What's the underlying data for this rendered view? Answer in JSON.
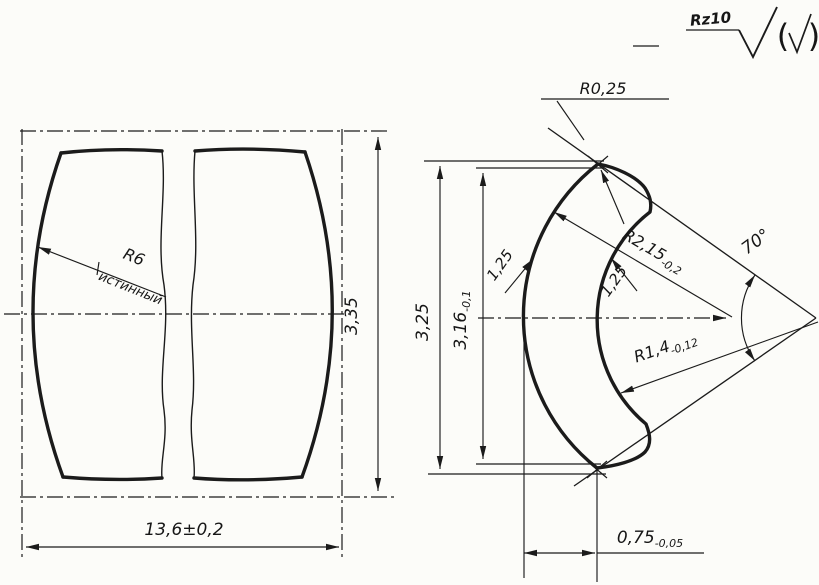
{
  "drawing": {
    "surface_finish": {
      "roughness_grade": "Rz10",
      "paren_open": "(",
      "paren_close": ")"
    },
    "left_view": {
      "radius_label": "R6",
      "radius_note": "истинный",
      "height_dim": "3,35",
      "width_dim": "13,6±0,2"
    },
    "right_view": {
      "tip_radius": "R0,25",
      "outer_height": "3,25",
      "inner_height": "3,16",
      "inner_height_tol": "-0,1",
      "outer_thickness": "1,25",
      "inner_thickness": "1,25",
      "outer_radius": "R2,15",
      "outer_radius_tol": "-0,2",
      "inner_radius": "R1,4",
      "inner_radius_tol": "-0,12",
      "angle": "70°",
      "bottom_width": "0,75",
      "bottom_width_tol": "-0,05"
    }
  }
}
